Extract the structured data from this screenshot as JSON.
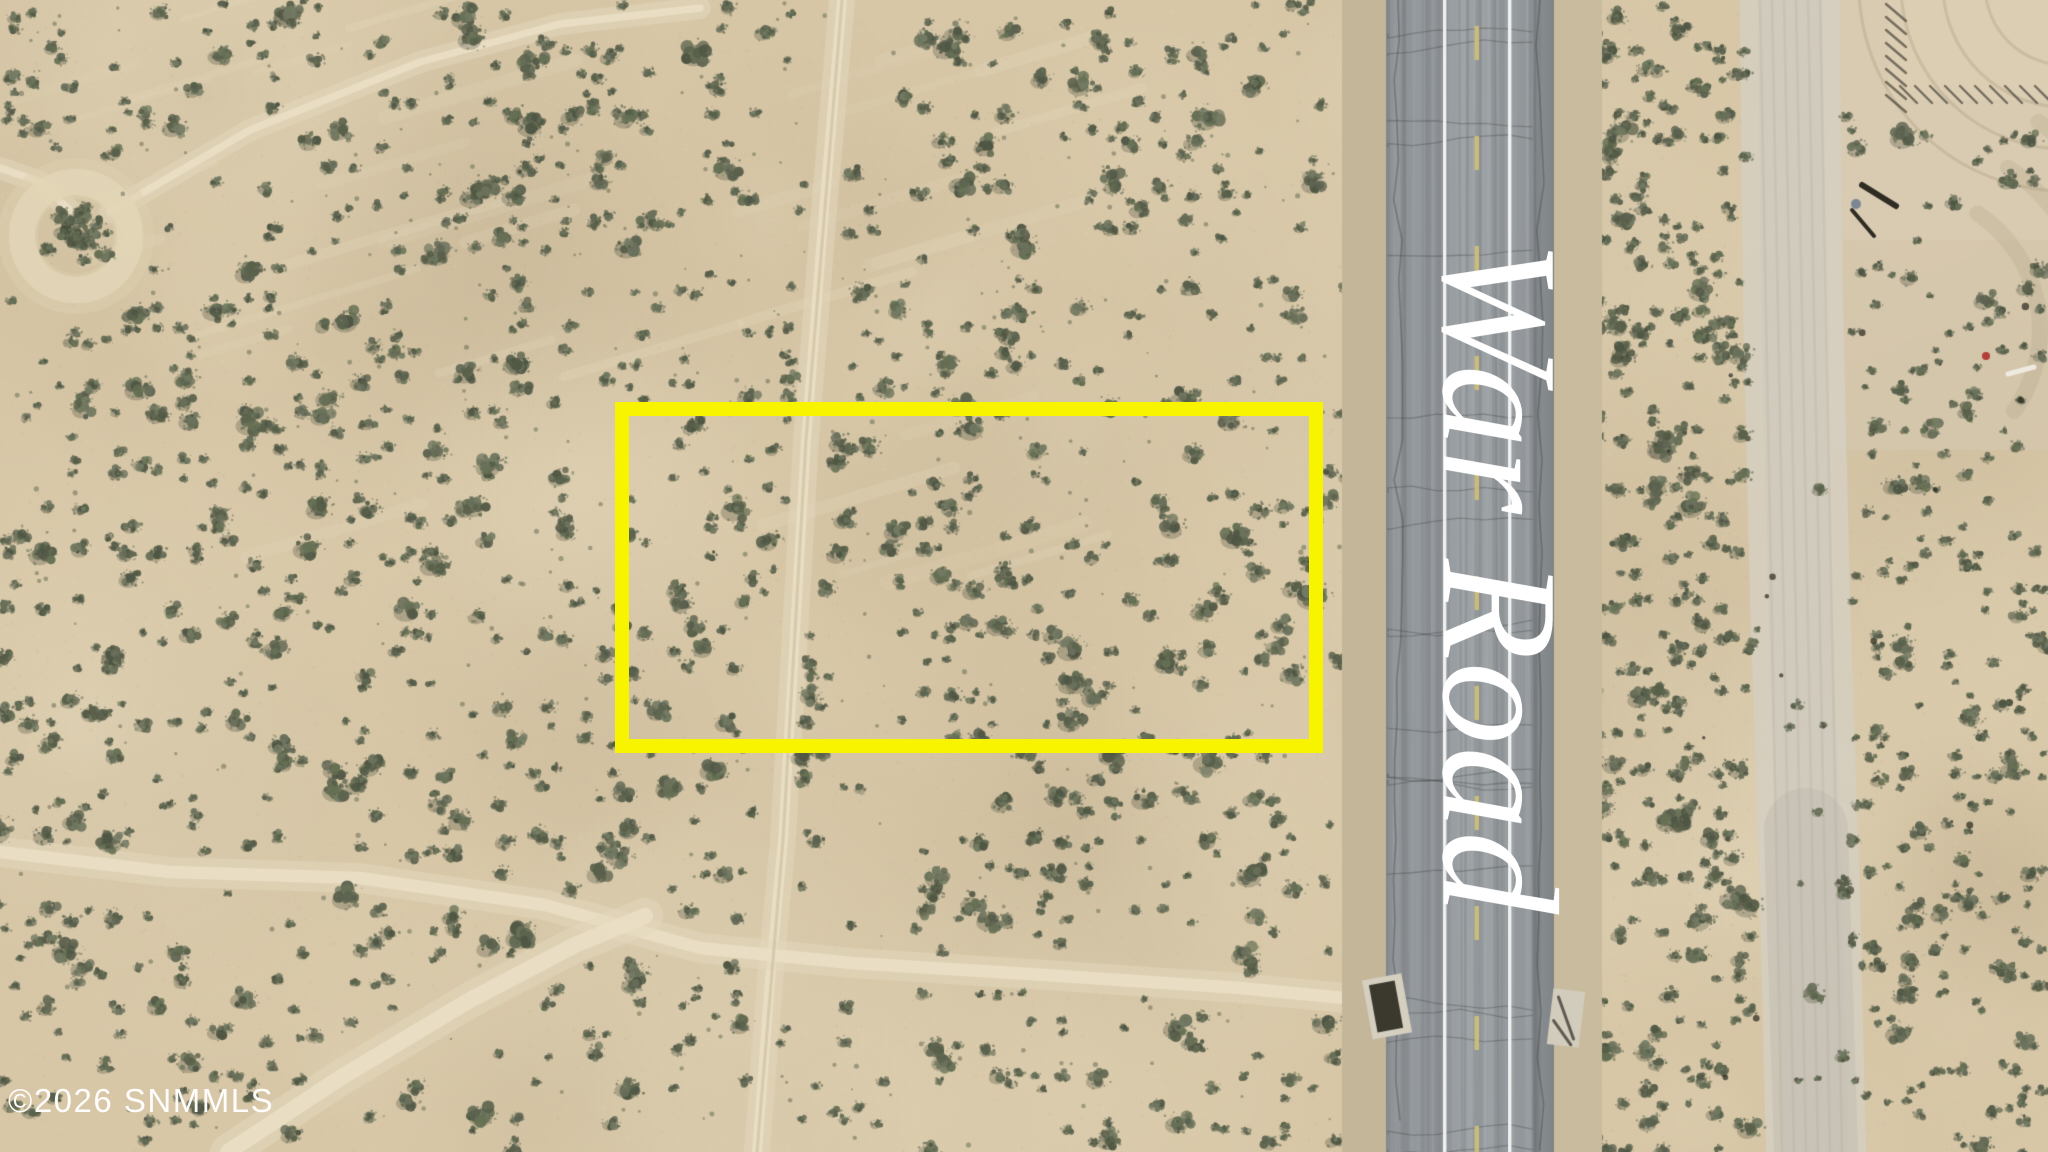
{
  "road": {
    "label": "War Road",
    "label_color": "#ffffff"
  },
  "watermark": {
    "text": "©2026 SNMMLS",
    "color": "#ffffff"
  },
  "parcel": {
    "outline_color": "#f8f400"
  }
}
